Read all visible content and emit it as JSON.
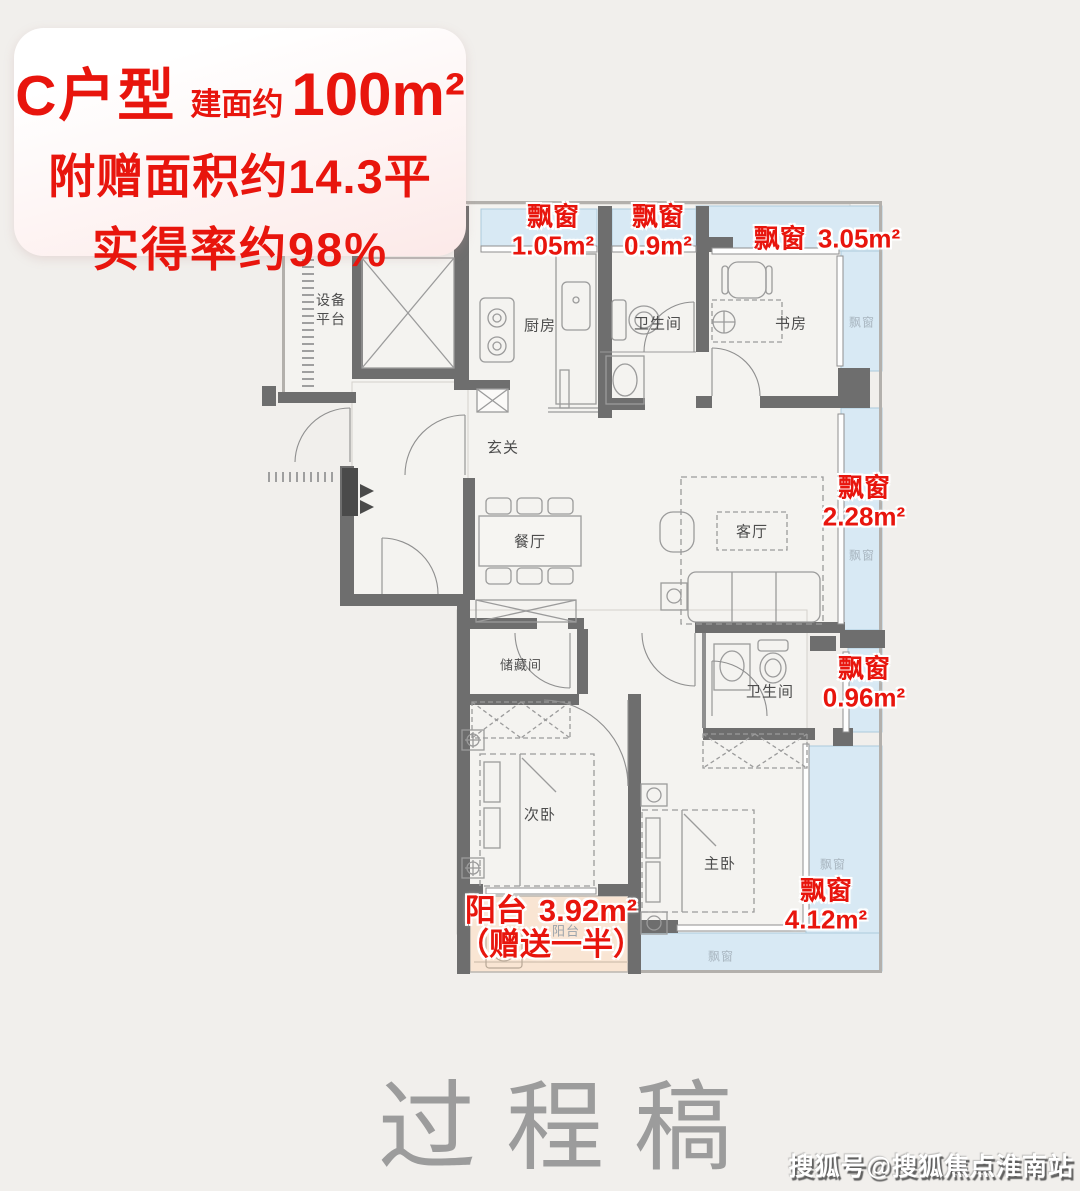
{
  "title_card": {
    "unit_type": "C户型",
    "area_prefix": "建面约",
    "area_value": "100m²",
    "bonus_area": "附赠面积约14.3平",
    "net_rate": "实得率约98%"
  },
  "rooms": {
    "equipment_platform": "设备平台",
    "kitchen": "厨房",
    "bathroom_top": "卫生间",
    "study": "书房",
    "foyer": "玄关",
    "dining": "餐厅",
    "living": "客厅",
    "storage": "储藏间",
    "bathroom_lower": "卫生间",
    "bedroom_second": "次卧",
    "bedroom_master": "主卧",
    "balcony": "阳台"
  },
  "bay_tag": "飘窗",
  "annotations": {
    "bay_kitchen": {
      "label": "飘窗",
      "value": "1.05m²"
    },
    "bay_bath_top": {
      "label": "飘窗",
      "value": "0.9m²"
    },
    "bay_study": {
      "label": "飘窗",
      "value": "3.05m²"
    },
    "bay_living": {
      "label": "飘窗",
      "value": "2.28m²"
    },
    "bay_bath_lower": {
      "label": "飘窗",
      "value": "0.96m²"
    },
    "bay_master": {
      "label": "飘窗",
      "value": "4.12m²"
    },
    "balcony": {
      "label": "阳台",
      "value": "3.92m²",
      "note": "（赠送一半）"
    }
  },
  "watermarks": {
    "draft": "过程稿",
    "credit": "搜狐号@搜狐焦点淮南站"
  },
  "colors": {
    "accent_red": "#e8150d",
    "wall": "#6e6e6e",
    "bay_fill": "#d8e9f4",
    "balcony_fill": "#f9e5d3",
    "background": "#f1efec"
  }
}
